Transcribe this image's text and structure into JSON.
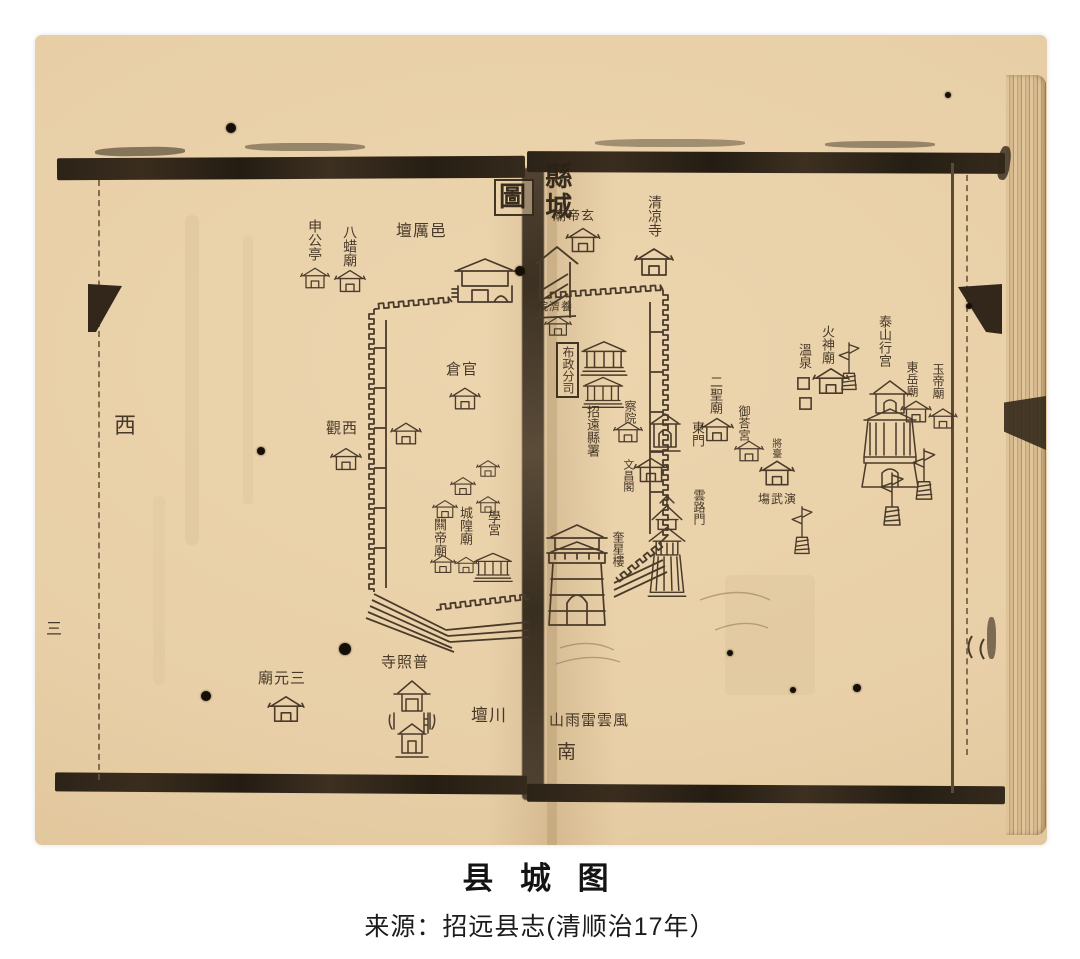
{
  "caption": {
    "title": "县 城 图",
    "source": "来源：招远县志(清顺治17年）"
  },
  "ink": {
    "line": "#4a3a2a",
    "frame": "#2c2318",
    "paper": "#e8cfa7"
  },
  "map": {
    "labels": [
      {
        "name": "map-title-tu",
        "text": "圖",
        "x": 494,
        "y": 179,
        "s": 27,
        "o": "h",
        "box": true,
        "title": true
      },
      {
        "name": "map-title-xiancheng",
        "text": "縣城",
        "x": 541,
        "y": 162,
        "s": 27,
        "o": "v",
        "title": true
      },
      {
        "name": "label-yi-li-tan",
        "text": "壇厲邑",
        "x": 396,
        "y": 223,
        "s": 16,
        "o": "h"
      },
      {
        "name": "label-ba-zha-miao",
        "text": "八蜡廟",
        "x": 341,
        "y": 225,
        "s": 14,
        "o": "v"
      },
      {
        "name": "label-shen-gong-ting",
        "text": "申公亭",
        "x": 306,
        "y": 219,
        "s": 14,
        "o": "v"
      },
      {
        "name": "label-guan-cang",
        "text": "倉官",
        "x": 446,
        "y": 362,
        "s": 15,
        "o": "h"
      },
      {
        "name": "label-xi-guan",
        "text": "觀西",
        "x": 326,
        "y": 421,
        "s": 15,
        "o": "h"
      },
      {
        "name": "compass-west",
        "text": "西",
        "x": 114,
        "y": 414,
        "s": 22,
        "o": "h"
      },
      {
        "name": "folio-number",
        "text": "三",
        "x": 46,
        "y": 621,
        "s": 16,
        "o": "h"
      },
      {
        "name": "label-xue-gong",
        "text": "學宮",
        "x": 486,
        "y": 510,
        "s": 13,
        "o": "v"
      },
      {
        "name": "label-cheng-huang-miao",
        "text": "城隍廟",
        "x": 458,
        "y": 506,
        "s": 13,
        "o": "v"
      },
      {
        "name": "label-guan-di-miao",
        "text": "闗帝廟",
        "x": 432,
        "y": 518,
        "s": 13,
        "o": "v"
      },
      {
        "name": "label-san-yuan-miao",
        "text": "廟元三",
        "x": 258,
        "y": 671,
        "s": 15,
        "o": "h"
      },
      {
        "name": "label-pu-zhao-si",
        "text": "寺照普",
        "x": 381,
        "y": 655,
        "s": 15,
        "o": "h"
      },
      {
        "name": "label-chuan-tan",
        "text": "壇川",
        "x": 471,
        "y": 707,
        "s": 17,
        "o": "h"
      },
      {
        "name": "label-xuan-di-miao",
        "text": "廟帝玄",
        "x": 553,
        "y": 209,
        "s": 13,
        "o": "h"
      },
      {
        "name": "label-qing-liang-si",
        "text": "清凉寺",
        "x": 646,
        "y": 195,
        "s": 14,
        "o": "v"
      },
      {
        "name": "label-yang-ji-yuan",
        "text": "院濟養",
        "x": 537,
        "y": 302,
        "s": 11,
        "o": "h"
      },
      {
        "name": "label-bu-zheng-fen-si",
        "text": "布政分司",
        "x": 556,
        "y": 342,
        "s": 12,
        "o": "v",
        "box": true
      },
      {
        "name": "label-zhaoyuan-xian-shu",
        "text": "招遠縣署",
        "x": 585,
        "y": 405,
        "s": 13,
        "o": "v"
      },
      {
        "name": "label-cha-yuan",
        "text": "察院",
        "x": 623,
        "y": 400,
        "s": 12,
        "o": "v"
      },
      {
        "name": "label-er-sheng-miao",
        "text": "二聖廟",
        "x": 708,
        "y": 375,
        "s": 13,
        "o": "v"
      },
      {
        "name": "label-dong-men",
        "text": "東門",
        "x": 690,
        "y": 421,
        "s": 13,
        "o": "v"
      },
      {
        "name": "label-yu-da-gong",
        "text": "御荅宮",
        "x": 737,
        "y": 405,
        "s": 12,
        "o": "v"
      },
      {
        "name": "label-yun-lu-men",
        "text": "雲路門",
        "x": 692,
        "y": 489,
        "s": 12,
        "o": "v"
      },
      {
        "name": "label-wen-chang-ge",
        "text": "文昌閣",
        "x": 621,
        "y": 459,
        "s": 11,
        "o": "v"
      },
      {
        "name": "label-kui-xing-lou",
        "text": "奎星樓",
        "x": 611,
        "y": 531,
        "s": 12,
        "o": "v"
      },
      {
        "name": "label-jiang-tai",
        "text": "將臺",
        "x": 769,
        "y": 438,
        "s": 10,
        "o": "v"
      },
      {
        "name": "label-yan-wu-chang",
        "text": "塲武演",
        "x": 758,
        "y": 493,
        "s": 12,
        "o": "h"
      },
      {
        "name": "label-huo-shen-miao",
        "text": "火神廟",
        "x": 820,
        "y": 325,
        "s": 13,
        "o": "v"
      },
      {
        "name": "label-wen-quan",
        "text": "溫泉",
        "x": 797,
        "y": 343,
        "s": 13,
        "o": "v"
      },
      {
        "name": "label-tai-shan-xing-gong",
        "text": "泰山行宫",
        "x": 877,
        "y": 315,
        "s": 13,
        "o": "v"
      },
      {
        "name": "label-dong-yue-miao",
        "text": "東岳廟",
        "x": 905,
        "y": 361,
        "s": 12,
        "o": "v"
      },
      {
        "name": "label-yu-di-miao",
        "text": "玉帝廟",
        "x": 931,
        "y": 363,
        "s": 12,
        "o": "v"
      },
      {
        "name": "label-feng-yun-lei-yu-shan",
        "text": "山雨雷雲風",
        "x": 549,
        "y": 713,
        "s": 15,
        "o": "h"
      },
      {
        "name": "compass-south",
        "text": "南",
        "x": 557,
        "y": 743,
        "s": 19,
        "o": "h"
      }
    ],
    "features": [
      {
        "t": "tpl",
        "x": 300,
        "y": 265,
        "w": 30,
        "h": 26,
        "name": "shen-gong-ting-building"
      },
      {
        "t": "tpl",
        "x": 334,
        "y": 267,
        "w": 32,
        "h": 28,
        "name": "ba-zha-miao-building"
      },
      {
        "t": "gate",
        "x": 450,
        "y": 256,
        "w": 70,
        "h": 64,
        "name": "north-gate-tower"
      },
      {
        "t": "tpl",
        "x": 449,
        "y": 385,
        "w": 32,
        "h": 27,
        "name": "guan-cang-building"
      },
      {
        "t": "tpl",
        "x": 390,
        "y": 420,
        "w": 32,
        "h": 27,
        "name": "west-wall-temple"
      },
      {
        "t": "tpl",
        "x": 330,
        "y": 445,
        "w": 32,
        "h": 28,
        "name": "xi-guan-building"
      },
      {
        "t": "tpl",
        "x": 476,
        "y": 458,
        "w": 24,
        "h": 21,
        "name": "temple-building"
      },
      {
        "t": "tpl",
        "x": 450,
        "y": 475,
        "w": 26,
        "h": 22,
        "name": "temple-building"
      },
      {
        "t": "tpl",
        "x": 476,
        "y": 494,
        "w": 24,
        "h": 21,
        "name": "temple-building"
      },
      {
        "t": "tpl",
        "x": 432,
        "y": 498,
        "w": 26,
        "h": 22,
        "name": "temple-building"
      },
      {
        "t": "tpl",
        "x": 430,
        "y": 553,
        "w": 26,
        "h": 22,
        "name": "guan-di-miao-building"
      },
      {
        "t": "tpl",
        "x": 454,
        "y": 555,
        "w": 24,
        "h": 20,
        "name": "cheng-huang-miao-building"
      },
      {
        "t": "hall",
        "x": 473,
        "y": 551,
        "w": 40,
        "h": 32,
        "name": "xue-gong-hall"
      },
      {
        "t": "tpl",
        "x": 267,
        "y": 693,
        "w": 38,
        "h": 32,
        "name": "san-yuan-miao-building"
      },
      {
        "t": "pz",
        "x": 388,
        "y": 677,
        "w": 48,
        "h": 88,
        "name": "pu-zhao-si-building"
      },
      {
        "t": "tpl",
        "x": 565,
        "y": 225,
        "w": 36,
        "h": 30,
        "name": "xuan-di-miao-building"
      },
      {
        "t": "tpl",
        "x": 633,
        "y": 245,
        "w": 42,
        "h": 34,
        "name": "qing-liang-si-building"
      },
      {
        "t": "tpl",
        "x": 544,
        "y": 314,
        "w": 28,
        "h": 24,
        "name": "yang-ji-yuan-building"
      },
      {
        "t": "hall",
        "x": 580,
        "y": 339,
        "w": 48,
        "h": 38,
        "name": "county-yamen-hall"
      },
      {
        "t": "hall",
        "x": 581,
        "y": 375,
        "w": 44,
        "h": 34,
        "name": "county-yamen-second-hall"
      },
      {
        "t": "tpl",
        "x": 613,
        "y": 419,
        "w": 30,
        "h": 26,
        "name": "cha-yuan-building"
      },
      {
        "t": "eg",
        "x": 648,
        "y": 411,
        "w": 34,
        "h": 44,
        "name": "dong-men-gate"
      },
      {
        "t": "tpl",
        "x": 700,
        "y": 415,
        "w": 34,
        "h": 29,
        "name": "er-sheng-miao-building"
      },
      {
        "t": "tpl",
        "x": 734,
        "y": 438,
        "w": 30,
        "h": 26,
        "name": "yu-da-gong-building"
      },
      {
        "t": "tpl",
        "x": 633,
        "y": 455,
        "w": 36,
        "h": 30,
        "name": "wen-chang-ge-building"
      },
      {
        "t": "pg",
        "x": 644,
        "y": 494,
        "w": 46,
        "h": 116,
        "name": "kui-xing-lou-pagoda"
      },
      {
        "t": "sg",
        "x": 541,
        "y": 520,
        "w": 72,
        "h": 112,
        "name": "south-gate-tower"
      },
      {
        "t": "tpl",
        "x": 759,
        "y": 457,
        "w": 36,
        "h": 32,
        "name": "yan-wu-chang-building"
      },
      {
        "t": "bn",
        "x": 837,
        "y": 341,
        "w": 24,
        "h": 52,
        "name": "banner-stand"
      },
      {
        "t": "pl",
        "x": 796,
        "y": 376,
        "w": 15,
        "h": 15,
        "name": "hot-spring-pool"
      },
      {
        "t": "pl",
        "x": 798,
        "y": 396,
        "w": 15,
        "h": 15,
        "name": "hot-spring-pool"
      },
      {
        "t": "tpl",
        "x": 812,
        "y": 365,
        "w": 38,
        "h": 32,
        "name": "huo-shen-miao-building"
      },
      {
        "t": "bt",
        "x": 854,
        "y": 379,
        "w": 72,
        "h": 115,
        "name": "tai-shan-xing-gong-building"
      },
      {
        "t": "tpl",
        "x": 900,
        "y": 398,
        "w": 32,
        "h": 27,
        "name": "dong-yue-miao-building"
      },
      {
        "t": "tpl",
        "x": 928,
        "y": 406,
        "w": 30,
        "h": 25,
        "name": "yu-di-miao-building"
      },
      {
        "t": "bn",
        "x": 879,
        "y": 471,
        "w": 26,
        "h": 58,
        "name": "banner-stand"
      },
      {
        "t": "bn",
        "x": 911,
        "y": 447,
        "w": 26,
        "h": 56,
        "name": "banner-stand"
      },
      {
        "t": "bn",
        "x": 790,
        "y": 505,
        "w": 24,
        "h": 52,
        "name": "banner-stand"
      }
    ],
    "holes": [
      [
        231,
        128,
        5
      ],
      [
        520,
        271,
        5
      ],
      [
        261,
        451,
        4
      ],
      [
        206,
        696,
        5
      ],
      [
        345,
        649,
        6
      ],
      [
        857,
        688,
        4
      ],
      [
        948,
        95,
        3
      ],
      [
        730,
        653,
        3
      ],
      [
        793,
        690,
        3
      ],
      [
        969,
        306,
        3
      ]
    ]
  }
}
